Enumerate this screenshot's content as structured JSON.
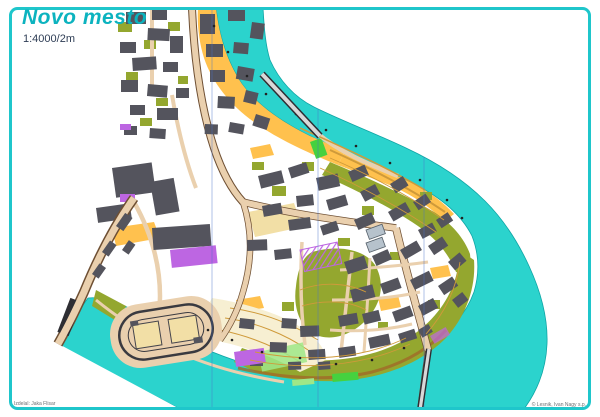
{
  "header": {
    "title": "Novo mesto",
    "scale": "1:4000/2m"
  },
  "footer": {
    "credit_left": "Izdelal: Jaka Flisar",
    "credit_right": "© Lesnik, Ivan Nagy s.p."
  },
  "map": {
    "colors": {
      "teal-border": "#1fc6cb",
      "teal-title": "#0cb3bf",
      "scale-text": "#2e3d55",
      "credit-text": "#6b6f73",
      "water": "#2bd3cd",
      "water-edge": "#0fa5a5",
      "building": "#54545d",
      "olive": "#94a72f",
      "orange": "#ffc14e",
      "road": "#ead0ae",
      "road-casing": "#6e4f33",
      "pale": "#f7efd2",
      "pale-court": "#f2dfa6",
      "purple": "#bd66e2",
      "green-bright": "#46d13f",
      "green-light": "#9fe788",
      "contour": "#cf9a3a",
      "shore-band": "#a06a28",
      "bridge-dark": "#2e2e33",
      "bridge-light": "#d8d8d8",
      "north-line": "#4a72c8",
      "blue-building": "#b6c2cc"
    }
  }
}
